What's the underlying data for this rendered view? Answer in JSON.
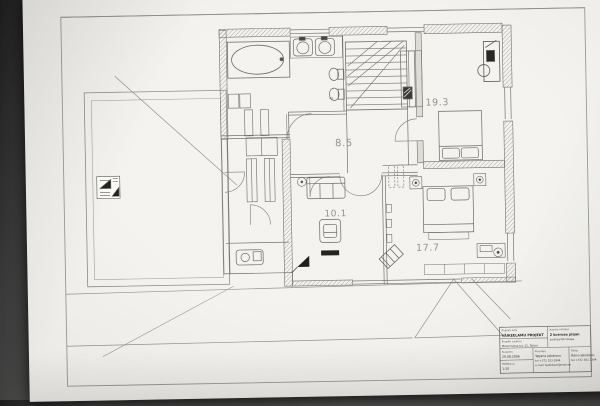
{
  "scene": {
    "description": "Photograph of an architectural second-floor plan sheet",
    "background_color": "#4a4a49",
    "paper_color": "#f3f2ee",
    "ink_color": "#5f5f5d"
  },
  "plan": {
    "room_labels": {
      "bedroom_ne": "19.3",
      "hall": "8.5",
      "living": "10.1",
      "bedroom_se": "17.7"
    },
    "wc_label": "wc"
  },
  "title_block": {
    "project_label": "Projekti nimi",
    "project_name": "VÄIKEELAMU PROJEKT",
    "address_label": "Projekti aadress",
    "address": "Männimetsa tee 15, Tallinn",
    "drawing_label": "Joonise nimetus",
    "drawing_name_line1": "2 korruse plaan",
    "drawing_name_line2": "sanitaartehnikaga",
    "date_label": "Kuupäev",
    "date": "29.08.2006",
    "scale_label": "Mõõtkava",
    "scale": "1:50",
    "author_label": "Koostaja",
    "author_name": "Tatjana Jakobson",
    "author_phone": "tel +372 523 5844",
    "author_email": "e-mail: tjakobson@mail.ee",
    "client_label": "Tellija",
    "client_name": "Raivo Jakobson",
    "client_phone": "tel +372 501 2344"
  }
}
